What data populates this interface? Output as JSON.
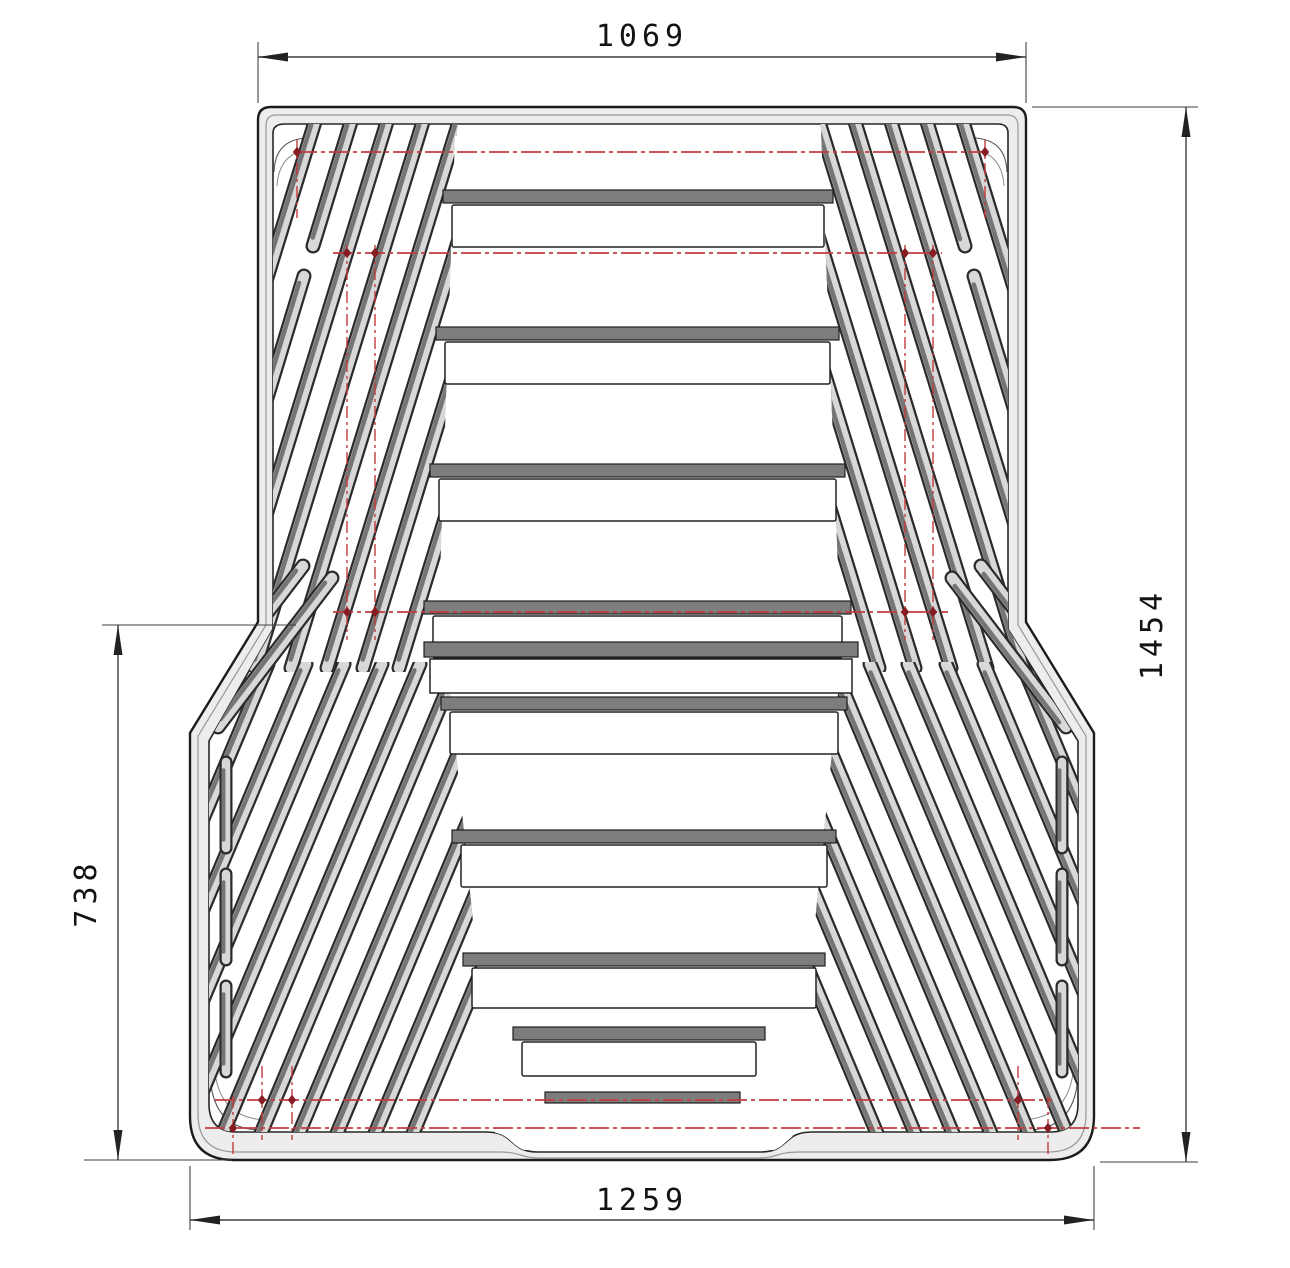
{
  "drawing": {
    "type": "2D CAD technical drawing",
    "subject": "pickup truck bed mat / liner - plan view with chevron rib pattern",
    "dimensions": {
      "top_width": {
        "label": "1069",
        "position": "top",
        "orientation": "horizontal"
      },
      "overall_length": {
        "label": "1454",
        "position": "right",
        "orientation": "vertical"
      },
      "lower_section_length": {
        "label": "738",
        "position": "left",
        "orientation": "vertical"
      },
      "bottom_width": {
        "label": "1259",
        "position": "bottom",
        "orientation": "horizontal"
      }
    },
    "colors": {
      "background": "#ffffff",
      "outline": "#1c1c1c",
      "rim_fill": "#ededed",
      "mid_contour": "#989898",
      "floor_fill": "#ffffff",
      "rib_outline": "#2b2b2b",
      "rib_body": "#d8d8d8",
      "rib_shade": "#757575",
      "riser_fill": "#7d7d7d",
      "datum_line": "#c23b3f",
      "datum_marker": "#871d22",
      "dim_line": "#3f3f3f",
      "dim_text": "#131313"
    }
  }
}
